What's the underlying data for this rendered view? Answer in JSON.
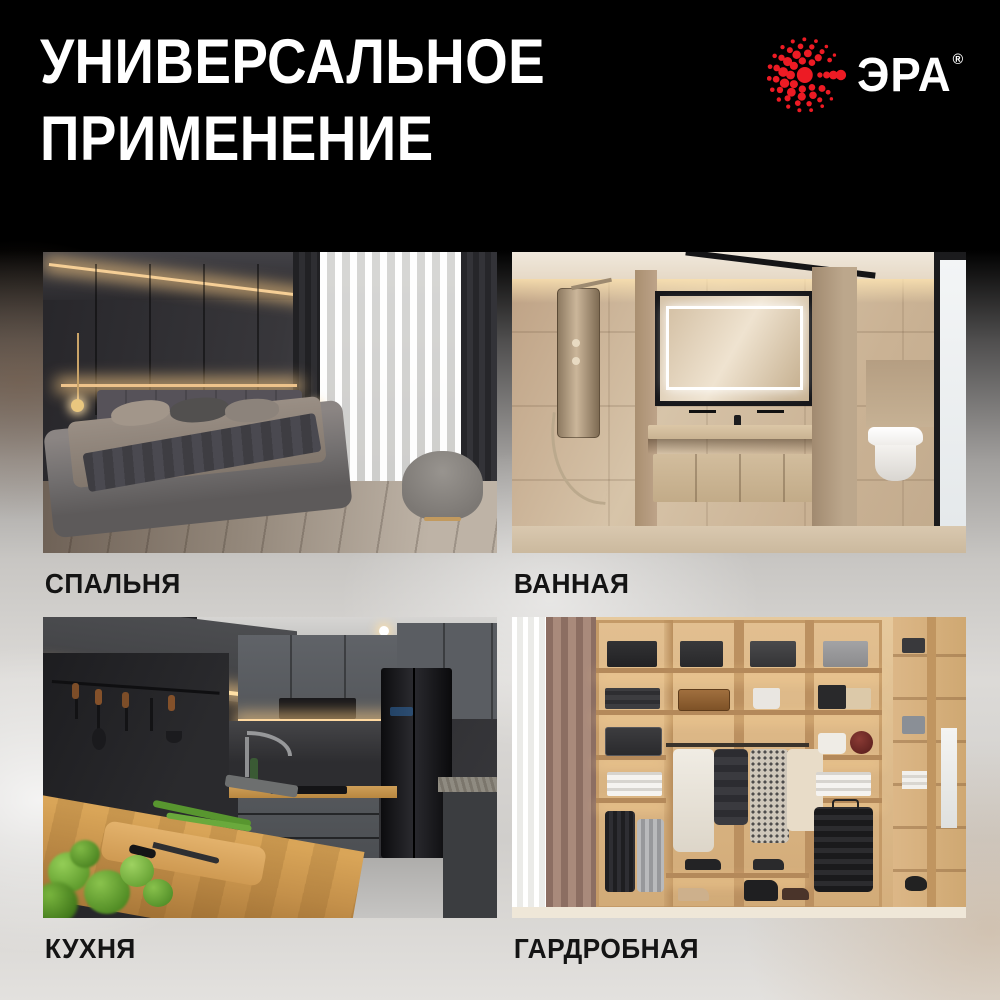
{
  "header": {
    "title_line1": "УНИВЕРСАЛЬНОЕ",
    "title_line2": "ПРИМЕНЕНИЕ"
  },
  "brand": {
    "name": "ЭРА",
    "registered": "®",
    "accent_color": "#ed1b24",
    "icon": "era-sunburst-dots-icon"
  },
  "theme": {
    "header_bg": "#000000",
    "title_color": "#ffffff",
    "label_color": "#141414",
    "body_bg_light": "#d8d6d3"
  },
  "rooms": [
    {
      "label": "СПАЛЬНЯ"
    },
    {
      "label": "ВАННАЯ"
    },
    {
      "label": "КУХНЯ"
    },
    {
      "label": "ГАРДРОБНАЯ"
    }
  ]
}
